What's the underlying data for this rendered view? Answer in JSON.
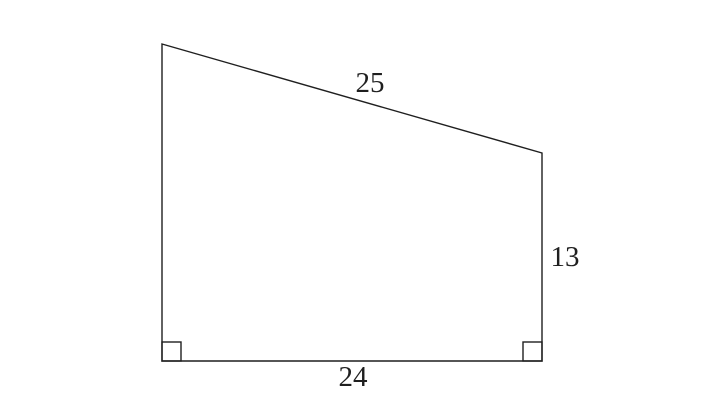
{
  "figure": {
    "type": "right-trapezoid",
    "background_color": "#ffffff",
    "stroke_color": "#1f1f1f",
    "text_color": "#1f1f1f",
    "stroke_width": 1.4,
    "label_font_size": 29,
    "canvas": {
      "width": 724,
      "height": 407
    },
    "vertices": [
      {
        "name": "top-left",
        "x": 162,
        "y": 44
      },
      {
        "name": "top-right",
        "x": 542,
        "y": 153
      },
      {
        "name": "bottom-right",
        "x": 542,
        "y": 361
      },
      {
        "name": "bottom-left",
        "x": 162,
        "y": 361
      }
    ],
    "labels": {
      "slant": {
        "text": "25",
        "x": 370,
        "y": 92
      },
      "right": {
        "text": "13",
        "x": 565,
        "y": 266
      },
      "bottom": {
        "text": "24",
        "x": 353,
        "y": 386
      }
    },
    "side_lengths": {
      "slant_top": 25,
      "right": 13,
      "bottom": 24
    },
    "right_angle_markers": [
      {
        "corner": "bottom-left",
        "size": 19
      },
      {
        "corner": "bottom-right",
        "size": 19
      }
    ]
  }
}
